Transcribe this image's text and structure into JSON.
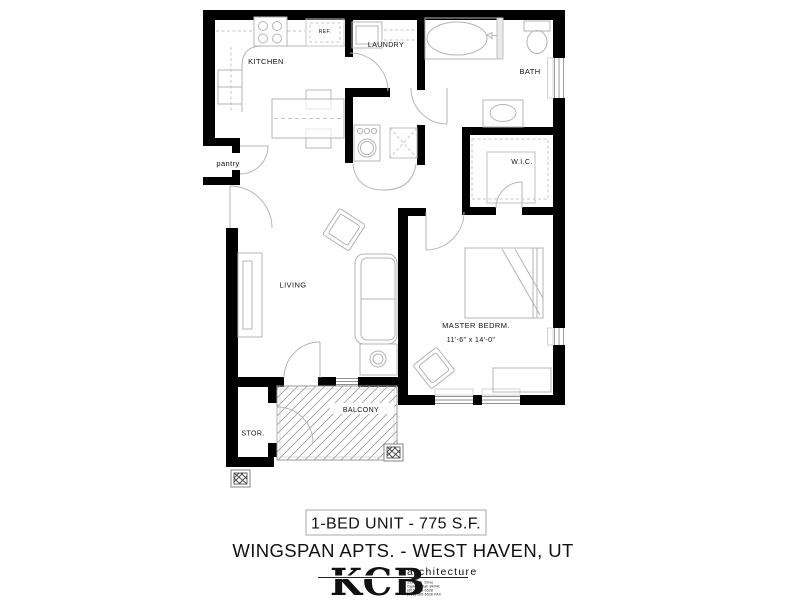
{
  "plan": {
    "rooms": {
      "kitchen": "KITCHEN",
      "laundry": "LAUNDRY",
      "bath": "BATH",
      "pantry": "pantry",
      "wic": "W.I.C.",
      "living": "LIVING",
      "master_bedroom": "MASTER BEDRM.",
      "master_bedroom_dims": "11'-6\" x 14'-0\"",
      "storage": "STOR.",
      "balcony": "BALCONY",
      "fridge": "REF."
    },
    "colors": {
      "wall": "#000000",
      "fixture_line": "#b4b4b4",
      "hatch_line": "#999999",
      "label_text": "#111111"
    }
  },
  "title_block": {
    "unit_label": "1-BED UNIT - 775 S.F.",
    "project_label": "WINGSPAN APTS. - WEST HAVEN, UT"
  },
  "logo": {
    "monogram": "KCB",
    "tagline": "architecture",
    "address_lines": [
      "3533 SW. Drive",
      "Ogden, Utah 84041",
      "(801) 565-6528",
      "(801) 565-6528 FAX"
    ]
  }
}
